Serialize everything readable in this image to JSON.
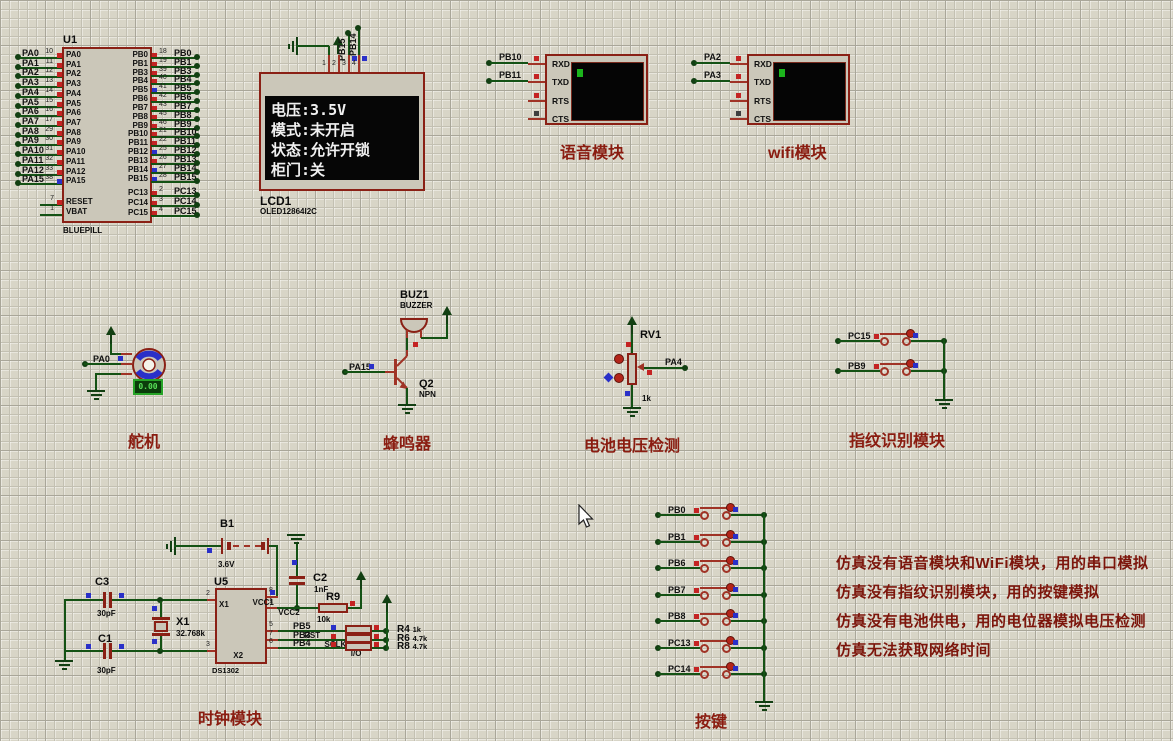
{
  "colors": {
    "wire": "#145214",
    "component_outline": "#8a2015",
    "component_fill": "#cbc7b9",
    "state_high": "#c42323",
    "state_low": "#2a30c8",
    "title_red": "#8a1c10",
    "grid_bg": "#d8d5c7",
    "screen_text": "#f0f0f0"
  },
  "u1": {
    "ref": "U1",
    "value": "BLUEPILL",
    "left_pins": [
      {
        "net": "PA0",
        "num": "10",
        "state": "red"
      },
      {
        "net": "PA1",
        "num": "11",
        "state": "red"
      },
      {
        "net": "PA2",
        "num": "12",
        "state": "red"
      },
      {
        "net": "PA3",
        "num": "13",
        "state": "red"
      },
      {
        "net": "PA4",
        "num": "14",
        "state": "red"
      },
      {
        "net": "PA5",
        "num": "15",
        "state": "red"
      },
      {
        "net": "PA6",
        "num": "16",
        "state": "red"
      },
      {
        "net": "PA7",
        "num": "17",
        "state": "red"
      },
      {
        "net": "PA8",
        "num": "29",
        "state": "red"
      },
      {
        "net": "PA9",
        "num": "30",
        "state": "red"
      },
      {
        "net": "PA10",
        "num": "31",
        "state": "red"
      },
      {
        "net": "PA11",
        "num": "32",
        "state": "red"
      },
      {
        "net": "PA12",
        "num": "33",
        "state": "red"
      },
      {
        "net": "PA15",
        "num": "38",
        "state": "blue"
      }
    ],
    "power_pins": [
      {
        "name": "RESET",
        "num": "7",
        "state": "red"
      },
      {
        "name": "VBAT",
        "num": "1",
        "state": ""
      }
    ],
    "right_pins": [
      {
        "net": "PB0",
        "num": "18",
        "state": "red"
      },
      {
        "net": "PB1",
        "num": "19",
        "state": "red"
      },
      {
        "net": "PB3",
        "num": "39",
        "state": "red"
      },
      {
        "net": "PB4",
        "num": "40",
        "state": "red"
      },
      {
        "net": "PB5",
        "num": "41",
        "state": "blue"
      },
      {
        "net": "PB6",
        "num": "42",
        "state": "red"
      },
      {
        "net": "PB7",
        "num": "43",
        "state": "red"
      },
      {
        "net": "PB8",
        "num": "45",
        "state": "red"
      },
      {
        "net": "PB9",
        "num": "46",
        "state": "red"
      },
      {
        "net": "PB10",
        "num": "21",
        "state": "red"
      },
      {
        "net": "PB11",
        "num": "22",
        "state": "red"
      },
      {
        "net": "PB12",
        "num": "25",
        "state": "blue"
      },
      {
        "net": "PB13",
        "num": "26",
        "state": "red"
      },
      {
        "net": "PB14",
        "num": "27",
        "state": "blue"
      },
      {
        "net": "PB15",
        "num": "28",
        "state": "blue"
      }
    ],
    "pc_pins": [
      {
        "net": "PC13",
        "num": "2",
        "state": "red"
      },
      {
        "net": "PC14",
        "num": "3",
        "state": "red"
      },
      {
        "net": "PC15",
        "num": "4",
        "state": "red"
      }
    ]
  },
  "lcd": {
    "ref": "LCD1",
    "value": "OLED12864I2C",
    "pins": [
      {
        "num": "1",
        "name": "GND",
        "state": ""
      },
      {
        "num": "2",
        "name": "VCC",
        "state": ""
      },
      {
        "num": "3",
        "name": "SCL",
        "state": "blue"
      },
      {
        "num": "4",
        "name": "SDA",
        "state": "blue"
      }
    ],
    "scl_net": "PB15",
    "sda_net": "PB14",
    "screen_lines": [
      "电压:3.5V",
      "模式:未开启",
      "状态:允许开锁",
      "柜门:关"
    ]
  },
  "voice": {
    "title": "语音模块",
    "pins": [
      {
        "name": "RXD",
        "net": "PB10",
        "state": "red"
      },
      {
        "name": "TXD",
        "net": "PB11",
        "state": "red"
      },
      {
        "name": "RTS",
        "net": "",
        "state": "red"
      },
      {
        "name": "CTS",
        "net": "",
        "state": "dark"
      }
    ]
  },
  "wifi": {
    "title": "wifi模块",
    "pins": [
      {
        "name": "RXD",
        "net": "PA2",
        "state": "red"
      },
      {
        "name": "TXD",
        "net": "PA3",
        "state": "red"
      },
      {
        "name": "RTS",
        "net": "",
        "state": "red"
      },
      {
        "name": "CTS",
        "net": "",
        "state": "dark"
      }
    ]
  },
  "servo": {
    "title": "舵机",
    "net": "PA0",
    "display": "0.00"
  },
  "buzzer": {
    "title": "蜂鸣器",
    "ref": "BUZ1",
    "value": "BUZZER",
    "transistor_ref": "Q2",
    "transistor_value": "NPN",
    "net": "PA15"
  },
  "battery_check": {
    "title": "电池电压检测",
    "ref": "RV1",
    "value": "1k",
    "net": "PA4"
  },
  "fingerprint": {
    "title": "指纹识别模块",
    "keys": [
      {
        "net": "PC15",
        "state": "red"
      },
      {
        "net": "PB9",
        "state": "red"
      }
    ]
  },
  "keys": {
    "title": "按键",
    "items": [
      {
        "net": "PB0",
        "state": "red"
      },
      {
        "net": "PB1",
        "state": "red"
      },
      {
        "net": "PB6",
        "state": "red"
      },
      {
        "net": "PB7",
        "state": "red"
      },
      {
        "net": "PB8",
        "state": "red"
      },
      {
        "net": "PC13",
        "state": "red"
      },
      {
        "net": "PC14",
        "state": "red"
      }
    ]
  },
  "clock": {
    "title": "时钟模块",
    "battery": {
      "ref": "B1",
      "value": "3.6V"
    },
    "c1": {
      "ref": "C1",
      "value": "30pF"
    },
    "c2": {
      "ref": "C2",
      "value": "1nF"
    },
    "c3": {
      "ref": "C3",
      "value": "30pF"
    },
    "r9": {
      "ref": "R9",
      "value": "10k"
    },
    "xtal": {
      "ref": "X1",
      "value": "32.768k"
    },
    "u5": {
      "ref": "U5",
      "value": "DS1302",
      "left": [
        {
          "num": "2",
          "name": "X1"
        },
        {
          "num": "3",
          "name": "X2"
        }
      ],
      "right_top": [
        {
          "num": "8",
          "name": "VCC1"
        },
        {
          "num": "1",
          "name": "VCC2"
        }
      ],
      "right_bot": [
        {
          "name": "RST"
        },
        {
          "name": "SCLK"
        },
        {
          "name": "I/O"
        }
      ]
    },
    "nets": [
      {
        "num": "5",
        "net": "PB5",
        "state": "blue",
        "res": "R4",
        "val": "1k"
      },
      {
        "num": "7",
        "net": "PB3",
        "state": "red",
        "res": "R6",
        "val": "4.7k"
      },
      {
        "num": "6",
        "net": "PB4",
        "state": "red",
        "res": "R8",
        "val": "4.7k"
      }
    ]
  },
  "notes": {
    "lines": [
      "仿真没有语音模块和WiFi模块，用的串口模拟",
      "仿真没有指纹识别模块，用的按键模拟",
      "仿真没有电池供电，用的电位器模拟电压检测",
      "仿真无法获取网络时间"
    ]
  }
}
